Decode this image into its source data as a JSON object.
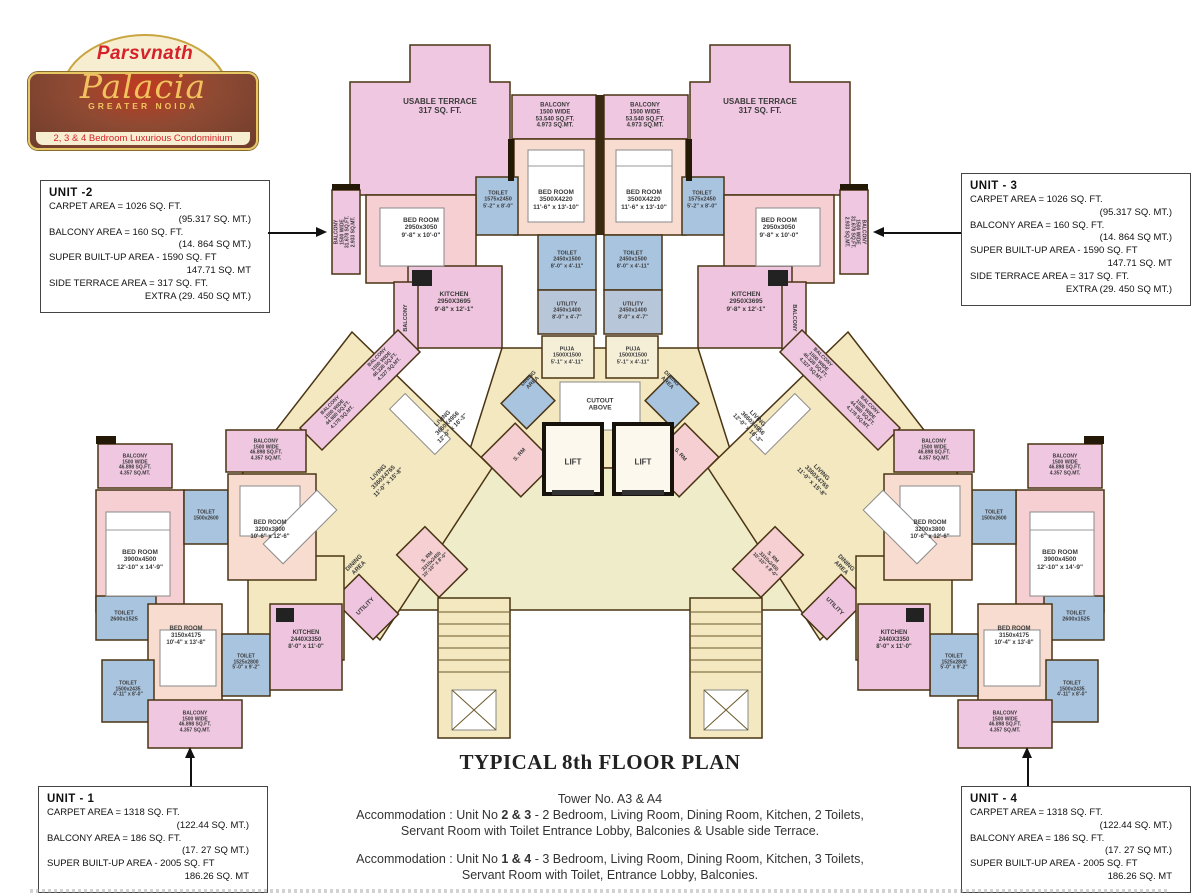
{
  "logo": {
    "brand": "Parsvnath",
    "name": "Palacia",
    "location": "GREATER NOIDA",
    "tagline": "2, 3 & 4 Bedroom Luxurious Condominium"
  },
  "title_block": {
    "title": "TYPICAL 8th FLOOR PLAN",
    "tower": "Tower No. A3 & A4",
    "acc1_prefix": "Accommodation : Unit No ",
    "acc1_units": "2 & 3",
    "acc1_rest": " - 2 Bedroom, Living Room, Dining Room, Kitchen, 2 Toilets,",
    "acc1_line2": "Servant Room with Toilet Entrance Lobby, Balconies & Usable side Terrace.",
    "acc2_prefix": "Accommodation : Unit No ",
    "acc2_units": "1 & 4",
    "acc2_rest": " - 3 Bedroom, Living Room, Dining Room, Kitchen, 3 Toilets,",
    "acc2_line2": "Servant Room with Toilet, Entrance Lobby, Balconies."
  },
  "unit_boxes": [
    {
      "id": "unit-1",
      "title": "UNIT - 1",
      "lines": [
        {
          "t": "CARPET AREA = 1318 SQ. FT.",
          "a": "l"
        },
        {
          "t": "(122.44 SQ. MT.)",
          "a": "r"
        },
        {
          "t": "BALCONY AREA = 186 SQ. FT.",
          "a": "l"
        },
        {
          "t": "(17. 27 SQ MT.)",
          "a": "r"
        },
        {
          "t": "SUPER BUILT-UP AREA - 2005 SQ. FT",
          "a": "l"
        },
        {
          "t": "186.26 SQ. MT",
          "a": "r"
        }
      ]
    },
    {
      "id": "unit-2",
      "title": "UNIT -2",
      "lines": [
        {
          "t": "CARPET AREA = 1026 SQ. FT.",
          "a": "l"
        },
        {
          "t": "(95.317 SQ. MT.)",
          "a": "r"
        },
        {
          "t": "BALCONY AREA = 160 SQ. FT.",
          "a": "l"
        },
        {
          "t": "(14. 864 SQ MT.)",
          "a": "r"
        },
        {
          "t": "SUPER BUILT-UP AREA - 1590 SQ. FT",
          "a": "l"
        },
        {
          "t": "147.71 SQ. MT",
          "a": "r"
        },
        {
          "t": "SIDE TERRACE AREA = 317 SQ. FT.",
          "a": "l"
        },
        {
          "t": "EXTRA (29. 450 SQ MT.)",
          "a": "r"
        }
      ]
    },
    {
      "id": "unit-3",
      "title": "UNIT - 3",
      "lines": [
        {
          "t": "CARPET AREA = 1026 SQ. FT.",
          "a": "l"
        },
        {
          "t": "(95.317 SQ. MT.)",
          "a": "r"
        },
        {
          "t": "BALCONY AREA = 160 SQ. FT.",
          "a": "l"
        },
        {
          "t": "(14. 864 SQ MT.)",
          "a": "r"
        },
        {
          "t": "SUPER BUILT-UP AREA - 1590 SQ. FT",
          "a": "l"
        },
        {
          "t": "147.71 SQ. MT",
          "a": "r"
        },
        {
          "t": "SIDE TERRACE AREA  = 317 SQ. FT.",
          "a": "l"
        },
        {
          "t": "EXTRA (29. 450 SQ MT.)",
          "a": "r"
        }
      ]
    },
    {
      "id": "unit-4",
      "title": "UNIT - 4",
      "lines": [
        {
          "t": "CARPET AREA = 1318 SQ. FT.",
          "a": "l"
        },
        {
          "t": "(122.44 SQ. MT.)",
          "a": "r"
        },
        {
          "t": "BALCONY AREA = 186 SQ. FT.",
          "a": "l"
        },
        {
          "t": "(17. 27 SQ MT.)",
          "a": "r"
        },
        {
          "t": "SUPER BUILT-UP AREA - 2005 SQ. FT",
          "a": "l"
        },
        {
          "t": "186.26 SQ. MT",
          "a": "r"
        }
      ]
    }
  ],
  "plan_labels": [
    {
      "n": "usable-terrace-left-label",
      "x": 440,
      "y": 106,
      "s": 8,
      "t": "USABLE TERRACE\n317 SQ. FT."
    },
    {
      "n": "usable-terrace-right-label",
      "x": 760,
      "y": 106,
      "s": 8,
      "t": "USABLE TERRACE\n317 SQ. FT."
    },
    {
      "n": "balcony-top-left-label",
      "x": 555,
      "y": 116,
      "s": 6,
      "t": "BALCONY\n1500 WIDE\n53.540 SQ.FT.\n4.973 SQ.MT."
    },
    {
      "n": "balcony-top-right-label",
      "x": 645,
      "y": 116,
      "s": 6,
      "t": "BALCONY\n1500 WIDE\n53.540 SQ.FT.\n4.973 SQ.MT."
    },
    {
      "n": "toilet-top-left-label",
      "x": 498,
      "y": 200,
      "s": 5.5,
      "t": "TOILET\n1575x2450\n5'-2\" x 8'-0\""
    },
    {
      "n": "toilet-top-right-label",
      "x": 702,
      "y": 200,
      "s": 5.5,
      "t": "TOILET\n1575x2450\n5'-2\" x 8'-0\""
    },
    {
      "n": "bedroom-center-left-label",
      "x": 556,
      "y": 200,
      "s": 6.5,
      "t": "BED ROOM\n3500X4220\n11'-6\" x 13'-10\""
    },
    {
      "n": "bedroom-center-right-label",
      "x": 644,
      "y": 200,
      "s": 6.5,
      "t": "BED ROOM\n3500X4220\n11'-6\" x 13'-10\""
    },
    {
      "n": "bedroom-side-left-label",
      "x": 421,
      "y": 228,
      "s": 6.5,
      "t": "BED ROOM\n2950x3050\n9'-8\" x 10'-0\""
    },
    {
      "n": "bedroom-side-right-label",
      "x": 779,
      "y": 228,
      "s": 6.5,
      "t": "BED ROOM\n2950x3050\n9'-8\" x 10'-0\""
    },
    {
      "n": "balcony-vert-left-upper-label",
      "x": 346,
      "y": 232,
      "r": -90,
      "s": 5,
      "t": "BALCONY\n1500 WIDE\n31.678 SQ.FT.\n2.933 SQ.MT."
    },
    {
      "n": "balcony-vert-right-upper-label",
      "x": 854,
      "y": 232,
      "r": 90,
      "s": 5,
      "t": "BALCONY\n1500 WIDE\n31.678 SQ.FT.\n2.933 SQ.MT."
    },
    {
      "n": "toilet-inner-left-label",
      "x": 567,
      "y": 260,
      "s": 5.5,
      "t": "TOILET\n2450x1500\n8'-0\" x 4'-11\""
    },
    {
      "n": "toilet-inner-right-label",
      "x": 633,
      "y": 260,
      "s": 5.5,
      "t": "TOILET\n2450x1500\n8'-0\" x 4'-11\""
    },
    {
      "n": "kitchen-upper-left-label",
      "x": 454,
      "y": 302,
      "s": 6.5,
      "t": "KITCHEN\n2950X3695\n9'-8\" x 12'-1\""
    },
    {
      "n": "kitchen-upper-right-label",
      "x": 746,
      "y": 302,
      "s": 6.5,
      "t": "KITCHEN\n2950X3695\n9'-8\" x 12'-1\""
    },
    {
      "n": "utility-center-left-label",
      "x": 567,
      "y": 311,
      "s": 5.5,
      "t": "UTILITY\n2450x1400\n8'-0\" x 4'-7\""
    },
    {
      "n": "utility-center-right-label",
      "x": 633,
      "y": 311,
      "s": 5.5,
      "t": "UTILITY\n2450x1400\n8'-0\" x 4'-7\""
    },
    {
      "n": "balcony-vert-left-lower-label",
      "x": 406,
      "y": 318,
      "r": -90,
      "s": 5.5,
      "t": "BALCONY"
    },
    {
      "n": "balcony-vert-right-lower-label",
      "x": 794,
      "y": 318,
      "r": 90,
      "s": 5.5,
      "t": "BALCONY"
    },
    {
      "n": "puja-left-label",
      "x": 567,
      "y": 356,
      "s": 5.5,
      "t": "PUJA\n1500X1500\n5'-1\" x 4'-11\""
    },
    {
      "n": "puja-right-label",
      "x": 633,
      "y": 356,
      "s": 5.5,
      "t": "PUJA\n1500X1500\n5'-1\" x 4'-11\""
    },
    {
      "n": "dining-upper-left-label",
      "x": 531,
      "y": 381,
      "r": -45,
      "s": 5.5,
      "t": "DINING\nAREA"
    },
    {
      "n": "dining-upper-right-label",
      "x": 669,
      "y": 381,
      "r": 45,
      "s": 5.5,
      "t": "DINING\nAREA"
    },
    {
      "n": "cutout-label",
      "x": 600,
      "y": 405,
      "s": 6.5,
      "t": "CUTOUT\nABOVE"
    },
    {
      "n": "lift-left-label",
      "x": 573,
      "y": 462,
      "s": 8,
      "t": "LIFT"
    },
    {
      "n": "lift-right-label",
      "x": 643,
      "y": 462,
      "s": 8,
      "t": "LIFT"
    },
    {
      "n": "servant-room-upper-left-label",
      "x": 520,
      "y": 455,
      "r": -48,
      "s": 5.5,
      "t": "S. RM"
    },
    {
      "n": "servant-room-upper-right-label",
      "x": 680,
      "y": 455,
      "r": 48,
      "s": 5.5,
      "t": "S. RM"
    },
    {
      "n": "balcony-diag-left-upper-label",
      "x": 384,
      "y": 364,
      "r": -45,
      "s": 5,
      "t": "BALCONY\n1500 WIDE\n46.328 SQ.FT.\n4.327 SQ.MT."
    },
    {
      "n": "balcony-diag-left-lower-label",
      "x": 337,
      "y": 412,
      "r": -45,
      "s": 5,
      "t": "BALCONY\n1500 WIDE\n44.980 SQ.FT.\n4.178 SQ.MT."
    },
    {
      "n": "balcony-diag-right-upper-label",
      "x": 816,
      "y": 364,
      "r": 45,
      "s": 5,
      "t": "BALCONY\n1500 WIDE\n46.328 SQ.FT.\n4.327 SQ.MT."
    },
    {
      "n": "balcony-diag-right-lower-label",
      "x": 863,
      "y": 412,
      "r": 45,
      "s": 5,
      "t": "BALCONY\n1500 WIDE\n44.980 SQ.FT.\n4.178 SQ.MT."
    },
    {
      "n": "living-unit2-label",
      "x": 448,
      "y": 424,
      "r": -45,
      "s": 6,
      "t": "LIVING\n3660X4956\n12'-0\" x 16'-3\""
    },
    {
      "n": "living-unit3-label",
      "x": 752,
      "y": 424,
      "r": 45,
      "s": 6,
      "t": "LIVING\n3660X4956\n12'-0\" x 16'-3\""
    },
    {
      "n": "living-unit1-label",
      "x": 384,
      "y": 478,
      "r": -45,
      "s": 6,
      "t": "LIVING\n3360X4765\n11'-0\" x 15'-8\""
    },
    {
      "n": "living-unit4-label",
      "x": 816,
      "y": 478,
      "r": 45,
      "s": 6,
      "t": "LIVING\n3360X4765\n11'-0\" x 15'-8\""
    },
    {
      "n": "dining-wing-left-label",
      "x": 357,
      "y": 566,
      "r": -45,
      "s": 6,
      "t": "DINING\nAREA"
    },
    {
      "n": "dining-wing-right-label",
      "x": 843,
      "y": 566,
      "r": 45,
      "s": 6,
      "t": "DINING\nAREA"
    },
    {
      "n": "utility-wing-left-label",
      "x": 366,
      "y": 607,
      "r": -45,
      "s": 6,
      "t": "UTILITY"
    },
    {
      "n": "utility-wing-right-label",
      "x": 834,
      "y": 607,
      "r": 45,
      "s": 6,
      "t": "UTILITY"
    },
    {
      "n": "servant-room-wing-left-label",
      "x": 432,
      "y": 562,
      "r": -45,
      "s": 5,
      "t": "S. RM\n3310x2450\n10'-10\" x 8'-0\""
    },
    {
      "n": "servant-room-wing-right-label",
      "x": 768,
      "y": 562,
      "r": 45,
      "s": 5,
      "t": "S. RM\n3310x2450\n10'-10\" x 8'-0\""
    },
    {
      "n": "balcony-outer-left-1-label",
      "x": 135,
      "y": 466,
      "s": 5,
      "t": "BALCONY\n1500 WIDE\n46.898 SQ.FT.\n4.357 SQ.MT."
    },
    {
      "n": "balcony-outer-left-2-label",
      "x": 266,
      "y": 451,
      "s": 5,
      "t": "BALCONY\n1500 WIDE\n46.898 SQ.FT.\n4.357 SQ.MT."
    },
    {
      "n": "bedroom-3900-left-label",
      "x": 140,
      "y": 560,
      "s": 6.5,
      "t": "BED ROOM\n3900x4500\n12'-10\" x 14'-9\""
    },
    {
      "n": "bedroom-3200-left-label",
      "x": 270,
      "y": 530,
      "s": 6,
      "t": "BED ROOM\n3200x3800\n10'-6\" x 12'-6\""
    },
    {
      "n": "toilet-1500x2600-left-label",
      "x": 206,
      "y": 516,
      "s": 5,
      "t": "TOILET\n1500x2600"
    },
    {
      "n": "toilet-master-left-label",
      "x": 124,
      "y": 617,
      "s": 5.5,
      "t": "TOILET\n2600x1525"
    },
    {
      "n": "bedroom-3150-left-label",
      "x": 186,
      "y": 636,
      "s": 6,
      "t": "BED ROOM\n3150x4175\n10'-4\" x 13'-8\""
    },
    {
      "n": "toilet-1525-left-label",
      "x": 246,
      "y": 663,
      "s": 5,
      "t": "TOILET\n1525x2800\n5'-0\" x 9'-2\""
    },
    {
      "n": "kitchen-lower-left-label",
      "x": 306,
      "y": 640,
      "s": 6,
      "t": "KITCHEN\n2440X3350\n8'-0\" x 11'-0\""
    },
    {
      "n": "toilet-2435-left-label",
      "x": 128,
      "y": 690,
      "s": 5,
      "t": "TOILET\n1500x2435\n4'-11\" x 8'-0\""
    },
    {
      "n": "balcony-lower-left-label",
      "x": 195,
      "y": 723,
      "s": 5,
      "t": "BALCONY\n1500 WIDE\n46.898 SQ.FT.\n4.357 SQ.MT."
    },
    {
      "n": "balcony-outer-right-1-label",
      "x": 1065,
      "y": 466,
      "s": 5,
      "t": "BALCONY\n1500 WIDE\n46.898 SQ.FT.\n4.357 SQ.MT."
    },
    {
      "n": "balcony-outer-right-2-label",
      "x": 934,
      "y": 451,
      "s": 5,
      "t": "BALCONY\n1500 WIDE\n46.898 SQ.FT.\n4.357 SQ.MT."
    },
    {
      "n": "bedroom-3900-right-label",
      "x": 1060,
      "y": 560,
      "s": 6.5,
      "t": "BED ROOM\n3900x4500\n12'-10\" x 14'-9\""
    },
    {
      "n": "bedroom-3200-right-label",
      "x": 930,
      "y": 530,
      "s": 6,
      "t": "BED ROOM\n3200x3800\n10'-6\" x 12'-6\""
    },
    {
      "n": "toilet-1500x2600-right-label",
      "x": 994,
      "y": 516,
      "s": 5,
      "t": "TOILET\n1500x2600"
    },
    {
      "n": "toilet-master-right-label",
      "x": 1076,
      "y": 617,
      "s": 5.5,
      "t": "TOILET\n2600x1525"
    },
    {
      "n": "bedroom-3150-right-label",
      "x": 1014,
      "y": 636,
      "s": 6,
      "t": "BED ROOM\n3150x4175\n10'-4\" x 13'-8\""
    },
    {
      "n": "toilet-1525-right-label",
      "x": 954,
      "y": 663,
      "s": 5,
      "t": "TOILET\n1525x2800\n5'-0\" x 9'-2\""
    },
    {
      "n": "kitchen-lower-right-label",
      "x": 894,
      "y": 640,
      "s": 6,
      "t": "KITCHEN\n2440X3350\n8'-0\" x 11'-0\""
    },
    {
      "n": "toilet-2435-right-label",
      "x": 1072,
      "y": 690,
      "s": 5,
      "t": "TOILET\n1500x2435\n4'-11\" x 8'-0\""
    },
    {
      "n": "balcony-lower-right-label",
      "x": 1005,
      "y": 723,
      "s": 5,
      "t": "BALCONY\n1500 WIDE\n46.898 SQ.FT.\n4.357 SQ.MT."
    }
  ]
}
